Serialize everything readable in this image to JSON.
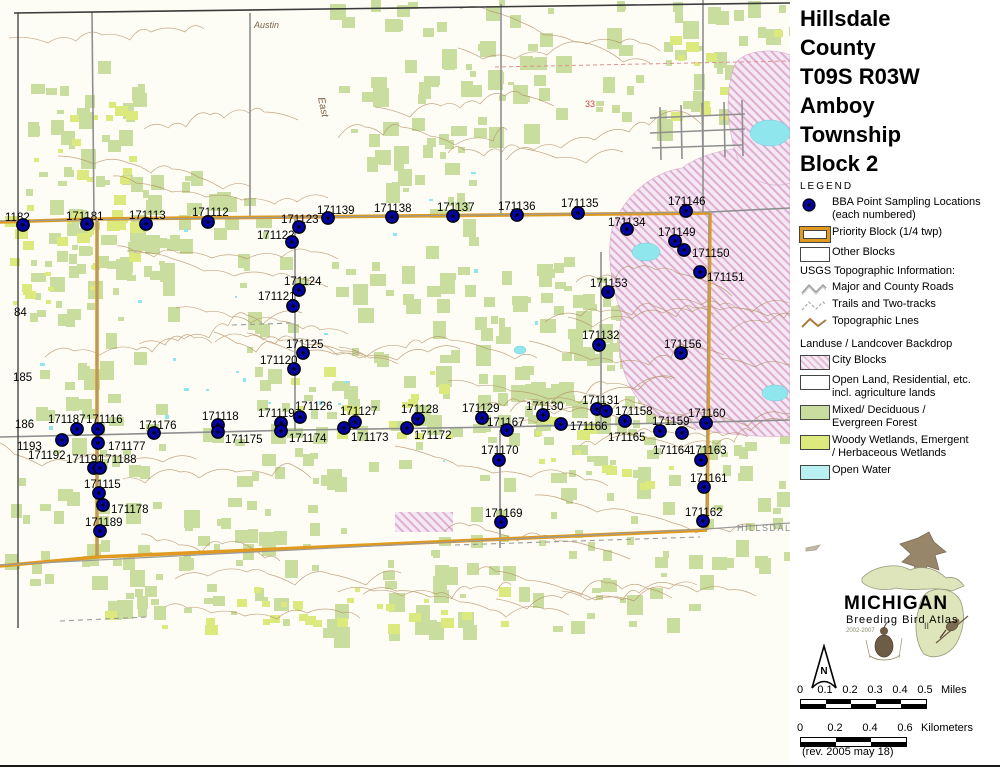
{
  "sidebar": {
    "title_lines": [
      "Hillsdale",
      "County",
      "T09S R03W",
      "Amboy",
      "Township",
      "Block 2"
    ],
    "legend_heading": "LEGEND",
    "bba": {
      "line1": "BBA Point Sampling Locations",
      "line2": "(each numbered)"
    },
    "priority_label": "Priority Block (1/4 twp)",
    "other_label": "Other Blocks",
    "usgs_heading": "USGS Topographic Information:",
    "usgs": [
      {
        "label": "Major and County Roads"
      },
      {
        "label": "Trails and Two-tracks"
      },
      {
        "label": "Topographic Lnes"
      }
    ],
    "landuse_heading": "Landuse / Landcover Backdrop",
    "landuse": [
      {
        "line1": "City Blocks",
        "line2": ""
      },
      {
        "line1": "Open Land, Residential, etc.",
        "line2": "incl. agriculture lands"
      },
      {
        "line1": "Mixed/ Deciduous /",
        "line2": "Evergreen Forest"
      },
      {
        "line1": "Woody Wetlands, Emergent",
        "line2": "/ Herbaceous Wetlands"
      },
      {
        "line1": "Open Water",
        "line2": ""
      }
    ],
    "logo": {
      "name": "MICHIGAN",
      "subtitle": "Breeding Bird Atlas",
      "years": "2002-2007",
      "numeral": "II"
    },
    "north_label": "N",
    "scale_miles": {
      "ticks": [
        "0",
        "0.1",
        "0.2",
        "0.3",
        "0.4",
        "0.5"
      ],
      "unit": "Miles"
    },
    "scale_km": {
      "ticks": [
        "0",
        "0.2",
        "0.4",
        "0.6"
      ],
      "unit": "Kilometers"
    },
    "revision": "(rev. 2005 may 18)"
  },
  "map": {
    "colors": {
      "dot": "#0202a0",
      "priority_orange": "#df9a1f",
      "forest": "#c9dd9f",
      "wetland": "#dcea7d",
      "water": "#8fe6ec",
      "city": "#f5e8f3",
      "city_hatch": "#dcaed2",
      "contour": "#b28a5c",
      "road": "#8f8f8f"
    },
    "points": [
      {
        "t": "1182",
        "x": 5,
        "y": 221
      },
      {
        "t": "171181",
        "x": 66,
        "y": 220
      },
      {
        "t": "171113",
        "x": 129,
        "y": 219
      },
      {
        "t": "171112",
        "x": 192,
        "y": 216
      },
      {
        "t": "171123",
        "x": 281,
        "y": 223
      },
      {
        "t": "171139",
        "x": 317,
        "y": 214
      },
      {
        "t": "171138",
        "x": 374,
        "y": 212
      },
      {
        "t": "171137",
        "x": 437,
        "y": 211
      },
      {
        "t": "171136",
        "x": 498,
        "y": 210
      },
      {
        "t": "171135",
        "x": 561,
        "y": 207
      },
      {
        "t": "171146",
        "x": 668,
        "y": 205
      },
      {
        "t": "171134",
        "x": 608,
        "y": 226
      },
      {
        "t": "171149",
        "x": 658,
        "y": 236
      },
      {
        "t": "171150",
        "x": 692,
        "y": 257
      },
      {
        "t": "171151",
        "x": 707,
        "y": 281
      },
      {
        "t": "171122",
        "x": 257,
        "y": 239
      },
      {
        "t": "171124",
        "x": 284,
        "y": 285
      },
      {
        "t": "171121",
        "x": 258,
        "y": 300
      },
      {
        "t": "171153",
        "x": 590,
        "y": 287
      },
      {
        "t": "171132",
        "x": 582,
        "y": 339
      },
      {
        "t": "171125",
        "x": 286,
        "y": 348
      },
      {
        "t": "171120",
        "x": 260,
        "y": 364
      },
      {
        "t": "171156",
        "x": 664,
        "y": 348
      },
      {
        "t": "84",
        "x": 14,
        "y": 316
      },
      {
        "t": "185",
        "x": 13,
        "y": 381
      },
      {
        "t": "186",
        "x": 15,
        "y": 428
      },
      {
        "t": "171187",
        "x": 48,
        "y": 423
      },
      {
        "t": "171116",
        "x": 86,
        "y": 423
      },
      {
        "t": "1193",
        "x": 17,
        "y": 450
      },
      {
        "t": "171192",
        "x": 28,
        "y": 459
      },
      {
        "t": "171177",
        "x": 108,
        "y": 450
      },
      {
        "t": "171191",
        "x": 66,
        "y": 463
      },
      {
        "t": "171188",
        "x": 99,
        "y": 463
      },
      {
        "t": "171115",
        "x": 84,
        "y": 488
      },
      {
        "t": "171178",
        "x": 111,
        "y": 513
      },
      {
        "t": "171189",
        "x": 85,
        "y": 526
      },
      {
        "t": "171118",
        "x": 202,
        "y": 420
      },
      {
        "t": "171175",
        "x": 225,
        "y": 443
      },
      {
        "t": "171176",
        "x": 139,
        "y": 429
      },
      {
        "t": "171119",
        "x": 258,
        "y": 417
      },
      {
        "t": "171126",
        "x": 295,
        "y": 410
      },
      {
        "t": "171174",
        "x": 289,
        "y": 442
      },
      {
        "t": "171127",
        "x": 340,
        "y": 415
      },
      {
        "t": "171173",
        "x": 351,
        "y": 441
      },
      {
        "t": "171128",
        "x": 401,
        "y": 413
      },
      {
        "t": "171172",
        "x": 414,
        "y": 439
      },
      {
        "t": "171129",
        "x": 462,
        "y": 412
      },
      {
        "t": "171167",
        "x": 487,
        "y": 426
      },
      {
        "t": "171130",
        "x": 526,
        "y": 410
      },
      {
        "t": "171166",
        "x": 570,
        "y": 430
      },
      {
        "t": "171131",
        "x": 582,
        "y": 404
      },
      {
        "t": "171158",
        "x": 615,
        "y": 415
      },
      {
        "t": "171159",
        "x": 652,
        "y": 425
      },
      {
        "t": "171165",
        "x": 608,
        "y": 441
      },
      {
        "t": "171160",
        "x": 688,
        "y": 417
      },
      {
        "t": "171164",
        "x": 653,
        "y": 454
      },
      {
        "t": "171163",
        "x": 689,
        "y": 454
      },
      {
        "t": "171161",
        "x": 690,
        "y": 482
      },
      {
        "t": "171170",
        "x": 481,
        "y": 454
      },
      {
        "t": "171169",
        "x": 485,
        "y": 517
      },
      {
        "t": "171162",
        "x": 685,
        "y": 516
      }
    ],
    "dots": [
      [
        23,
        225
      ],
      [
        87,
        224
      ],
      [
        146,
        224
      ],
      [
        208,
        222
      ],
      [
        299,
        227
      ],
      [
        328,
        218
      ],
      [
        392,
        217
      ],
      [
        453,
        216
      ],
      [
        517,
        215
      ],
      [
        578,
        213
      ],
      [
        686,
        211
      ],
      [
        627,
        229
      ],
      [
        675,
        241
      ],
      [
        684,
        250
      ],
      [
        700,
        272
      ],
      [
        292,
        242
      ],
      [
        299,
        290
      ],
      [
        293,
        306
      ],
      [
        608,
        292
      ],
      [
        599,
        345
      ],
      [
        303,
        353
      ],
      [
        294,
        369
      ],
      [
        681,
        353
      ],
      [
        77,
        429
      ],
      [
        98,
        429
      ],
      [
        62,
        440
      ],
      [
        98,
        443
      ],
      [
        94,
        468
      ],
      [
        100,
        468
      ],
      [
        99,
        493
      ],
      [
        103,
        505
      ],
      [
        100,
        531
      ],
      [
        218,
        425
      ],
      [
        218,
        432
      ],
      [
        154,
        433
      ],
      [
        281,
        423
      ],
      [
        281,
        431
      ],
      [
        300,
        417
      ],
      [
        355,
        422
      ],
      [
        344,
        428
      ],
      [
        418,
        419
      ],
      [
        407,
        428
      ],
      [
        482,
        418
      ],
      [
        507,
        430
      ],
      [
        543,
        415
      ],
      [
        561,
        424
      ],
      [
        597,
        409
      ],
      [
        606,
        411
      ],
      [
        625,
        421
      ],
      [
        660,
        431
      ],
      [
        682,
        433
      ],
      [
        706,
        423
      ],
      [
        701,
        460
      ],
      [
        704,
        487
      ],
      [
        499,
        460
      ],
      [
        501,
        522
      ],
      [
        703,
        521
      ]
    ],
    "place_labels": [
      {
        "text": "Austin",
        "x": 254,
        "y": 28,
        "color": "#7a6248",
        "size": 9,
        "rotate": 0,
        "italic": true
      },
      {
        "text": "East",
        "x": 318,
        "y": 98,
        "color": "#7a6248",
        "size": 10,
        "rotate": 78,
        "italic": true
      },
      {
        "text": "HILLSDAL",
        "x": 737,
        "y": 531,
        "color": "#8a8a8a",
        "size": 9,
        "rotate": 0,
        "italic": false
      },
      {
        "text": "33",
        "x": 585,
        "y": 107,
        "color": "#cc4444",
        "size": 9,
        "rotate": 0,
        "italic": false
      }
    ]
  }
}
